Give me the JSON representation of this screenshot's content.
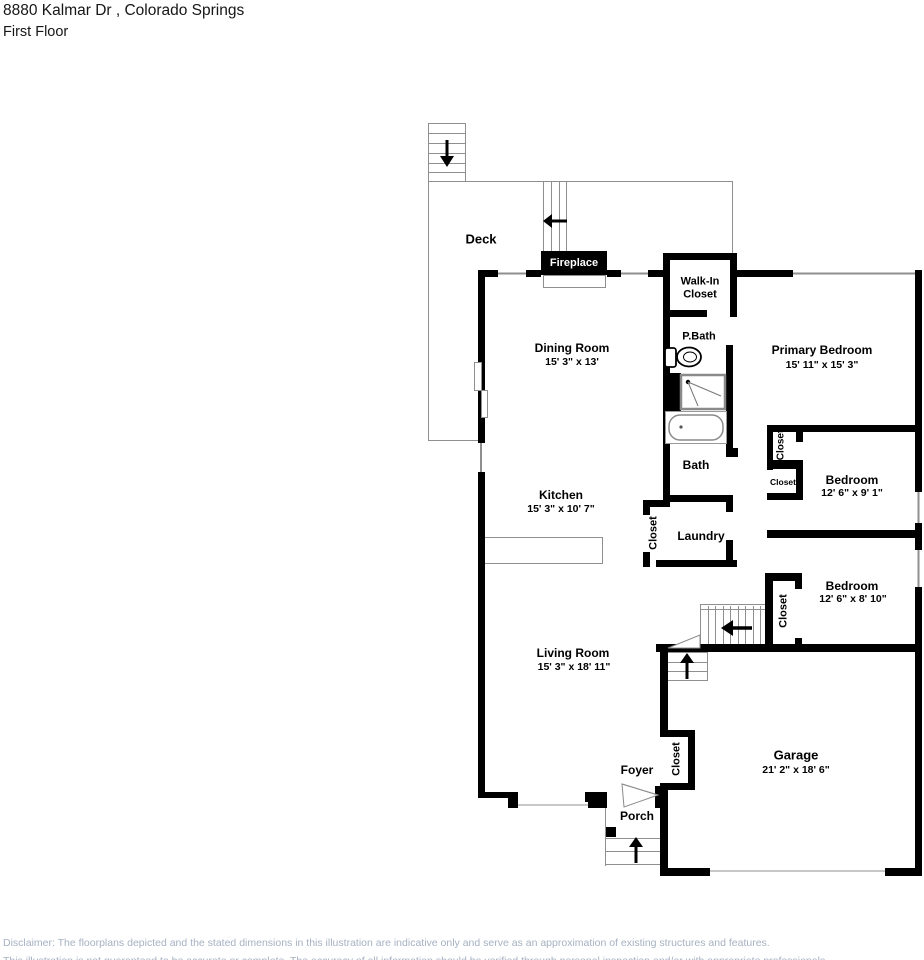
{
  "header": {
    "address": "8880 Kalmar Dr , Colorado Springs",
    "floor_label": "First Floor"
  },
  "rooms": {
    "deck": {
      "name": "Deck"
    },
    "fireplace": {
      "name": "Fireplace"
    },
    "walk_in_closet": {
      "name": "Walk-In Closet"
    },
    "dining_room": {
      "name": "Dining Room",
      "dims": "15' 3\" x 13'"
    },
    "primary_bath": {
      "name": "P.Bath"
    },
    "primary_bedroom": {
      "name": "Primary Bedroom",
      "dims": "15' 11\" x 15' 3\""
    },
    "bath": {
      "name": "Bath"
    },
    "kitchen": {
      "name": "Kitchen",
      "dims": "15' 3\" x 10' 7\""
    },
    "laundry": {
      "name": "Laundry"
    },
    "bedroom_1": {
      "name": "Bedroom",
      "dims": "12' 6\" x 9' 1\""
    },
    "bedroom_2": {
      "name": "Bedroom",
      "dims": "12' 6\" x 8' 10\""
    },
    "living_room": {
      "name": "Living Room",
      "dims": "15' 3\" x 18' 11\""
    },
    "garage": {
      "name": "Garage",
      "dims": "21' 2\" x 18' 6\""
    },
    "foyer": {
      "name": "Foyer"
    },
    "porch": {
      "name": "Porch"
    },
    "closet_label": "Closet"
  },
  "disclaimer": {
    "line1": "Disclaimer: The floorplans depicted and the stated dimensions in this illustration are indicative only and serve as an approximation of existing structures and features.",
    "line2": "This illustration is not guaranteed to be accurate or complete. The accuracy of all information should be verified through personal inspection and/or with appropriate professionals."
  },
  "colors": {
    "wall": "#000000",
    "thin_line": "#8f8f8f",
    "disclaimer_text": "#a6b1c2"
  }
}
